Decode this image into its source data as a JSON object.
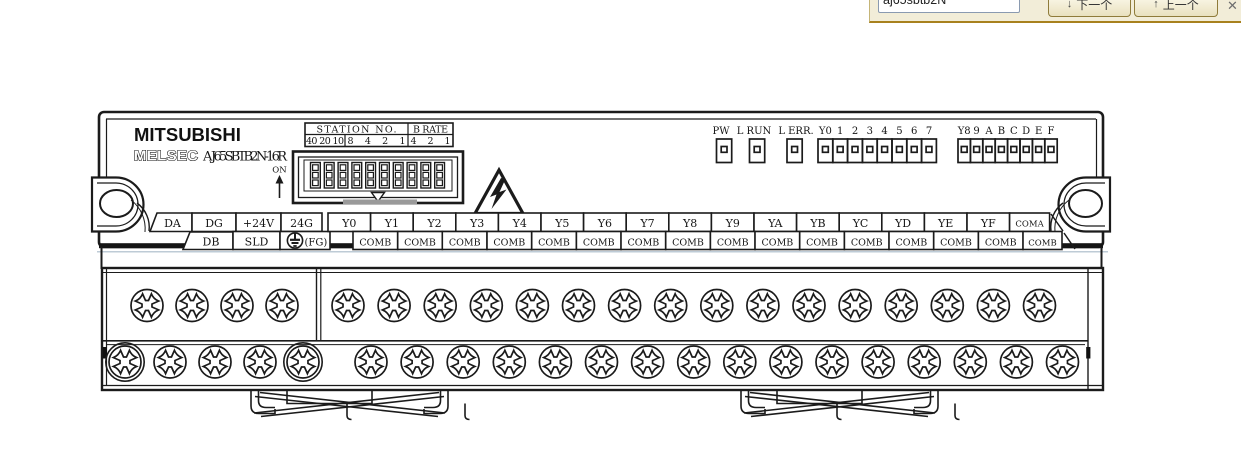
{
  "find_bar": {
    "query": "aj65sbtb2N",
    "next_icon": "↓",
    "next_label": "下一个",
    "prev_icon": "↑",
    "prev_label": "上一个",
    "close_label": "✕",
    "colors": {
      "background": "#f2edd8",
      "border": "#a8811e",
      "button_border": "#8f7b3a"
    }
  },
  "module": {
    "brand": "MITSUBISHI",
    "series_logo": "MELSEC",
    "model": "A J65SBTB2N-16R",
    "dip": {
      "station_header": "STATION NO.",
      "brate_header": "B RATE",
      "station_tens": "40 20 10",
      "station_ones": "8 4 2 1",
      "brate_bits": "4 2 1",
      "on_label": "ON",
      "switch_count": 10
    },
    "leds": {
      "singles": [
        "PW",
        "L RUN",
        "L ERR."
      ],
      "group1": [
        "Y0",
        "1",
        "2",
        "3",
        "4",
        "5",
        "6",
        "7"
      ],
      "group2": [
        "Y8",
        "9",
        "A",
        "B",
        "C",
        "D",
        "E",
        "F"
      ]
    },
    "terminals": {
      "top_left": [
        "DA",
        "DG",
        "+24V",
        "24G"
      ],
      "bottom_left": [
        "DB",
        "SLD"
      ],
      "fg_label": "(FG)",
      "outputs": [
        "Y0",
        "Y1",
        "Y2",
        "Y3",
        "Y4",
        "Y5",
        "Y6",
        "Y7",
        "Y8",
        "Y9",
        "YA",
        "YB",
        "YC",
        "YD",
        "YE",
        "YF"
      ],
      "coma_label": "COMA",
      "comb_label": "COMB",
      "comb_count": 16
    },
    "line_color": "#1b1b1b",
    "rule_color": "#a9bac9"
  }
}
